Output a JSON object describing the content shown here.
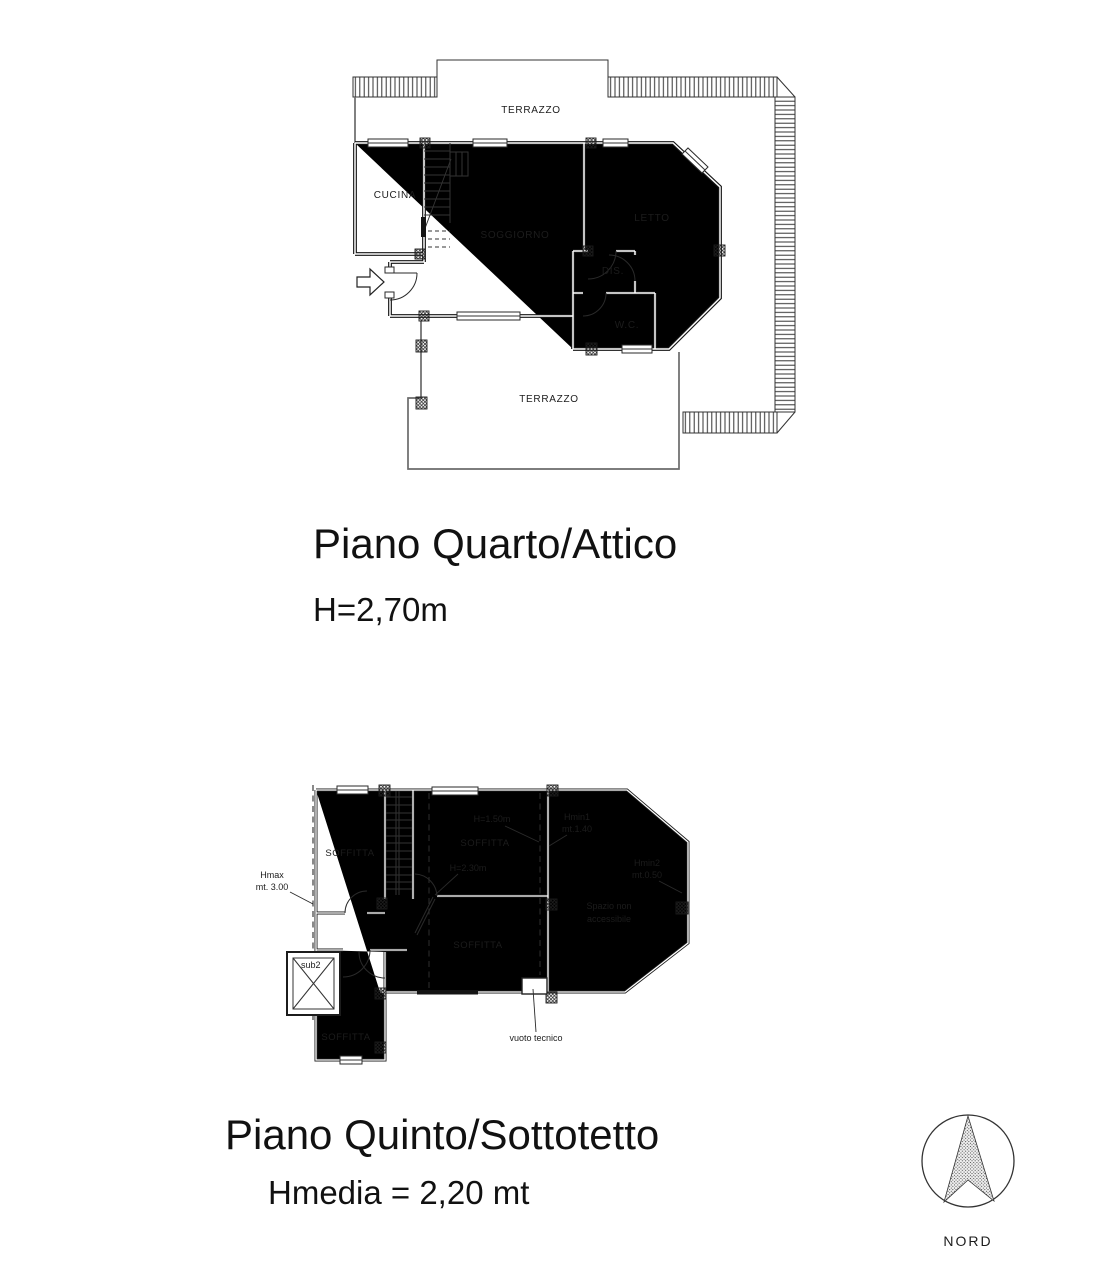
{
  "page": {
    "background": "#ffffff"
  },
  "attico": {
    "title": "Piano Quarto/Attico",
    "height_note": "H=2,70m",
    "rooms": {
      "terrazzo_top": "TERRAZZO",
      "cucina": "CUCINA",
      "soggiorno": "SOGGIORNO",
      "letto": "LETTO",
      "dis": "DIS.",
      "wc": "W.C.",
      "terrazzo_bottom": "TERRAZZO"
    }
  },
  "sottotetto": {
    "title": "Piano Quinto/Sottotetto",
    "height_note": "Hmedia = 2,20 mt",
    "rooms": {
      "soffitta_nw": "SOFFITTA",
      "soffitta_n": "SOFFITTA",
      "soffitta_c": "SOFFITTA",
      "soffitta_sw": "SOFFITTA",
      "sub2": "sub2",
      "spazio_line1": "Spazio non",
      "spazio_line2": "accessibile",
      "vuoto_tecnico": "vuoto tecnico"
    },
    "annotations": {
      "hmax_line1": "Hmax",
      "hmax_line2": "mt. 3.00",
      "h150": "H=1.50m",
      "h230": "H=2.30m",
      "hmin1_line1": "Hmin1",
      "hmin1_line2": "mt.1.40",
      "hmin2_line1": "Hmin2",
      "hmin2_line2": "mt.0.50"
    }
  },
  "compass": {
    "label": "NORD"
  },
  "colors": {
    "wall": "#151515",
    "thin_line": "#333333",
    "terrace_line": "#6b6b6b",
    "text": "#1c1c1c"
  }
}
